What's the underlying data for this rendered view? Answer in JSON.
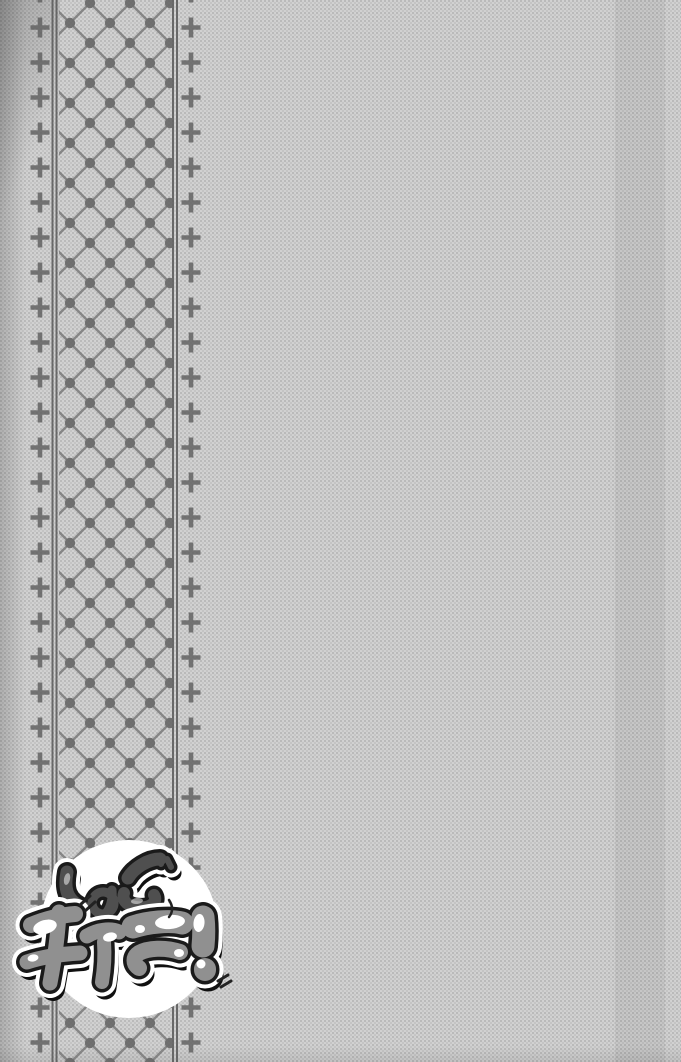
{
  "logo": {
    "top_text": "しゅご",
    "bottom_text": "キャラ!",
    "title": "しゅごキャラ!"
  },
  "colors": {
    "page_background": "#d2d2d2",
    "ornament_gray": "#636363",
    "rule_gray": "#585858",
    "lattice_line_gray": "#7b7b7b",
    "lattice_dot_gray": "#606060",
    "logo_circle": "#ffffff",
    "top_letters_fill": "#4f4f4f",
    "bottom_letters_fill": "#909090",
    "ink_outline": "#1a1a1a"
  },
  "ornament_icons": {
    "left_column": "cross-ornament-icon",
    "right_column": "cross-ornament-icon",
    "band": "diamond-lattice-dot-pattern"
  }
}
